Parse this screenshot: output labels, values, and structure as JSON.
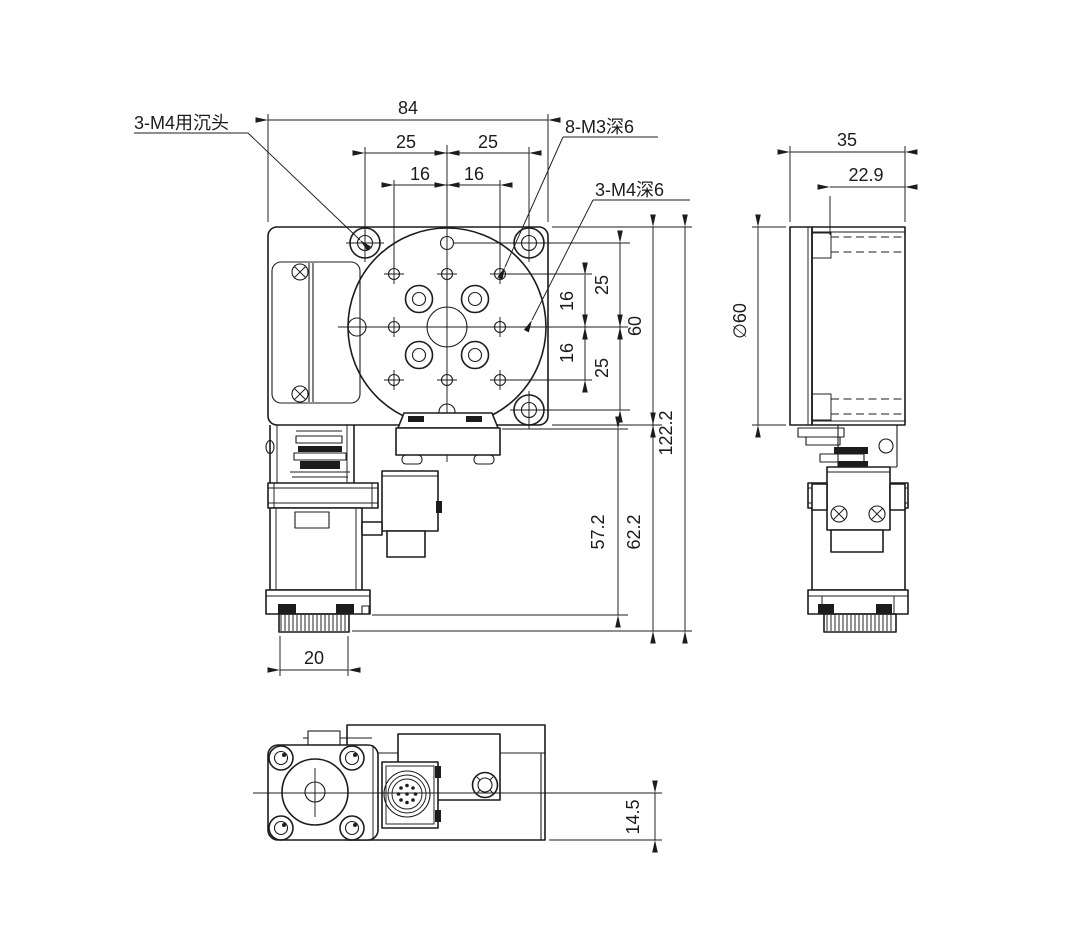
{
  "drawing": {
    "front_view": {
      "callout_counterbore": "3-M4用沉头",
      "callout_m3": "8-M3深6",
      "callout_m4": "3-M4深6",
      "dim_width": "84",
      "dim_25_left": "25",
      "dim_25_right": "25",
      "dim_16_left": "16",
      "dim_16_right": "16",
      "dim_25_top": "25",
      "dim_16_top": "16",
      "dim_16_bottom": "16",
      "dim_25_bottom": "25",
      "dim_height_60": "60",
      "dim_total_height": "122.2",
      "dim_motor_height": "57.2",
      "dim_motor_total": "62.2",
      "dim_knob_width": "20"
    },
    "side_view": {
      "dim_width": "35",
      "dim_depth": "22.9",
      "dim_diameter": "∅60"
    },
    "bottom_view": {
      "dim_offset": "14.5"
    },
    "colors": {
      "ink": "#1c1c1c",
      "paper": "#ffffff"
    }
  }
}
